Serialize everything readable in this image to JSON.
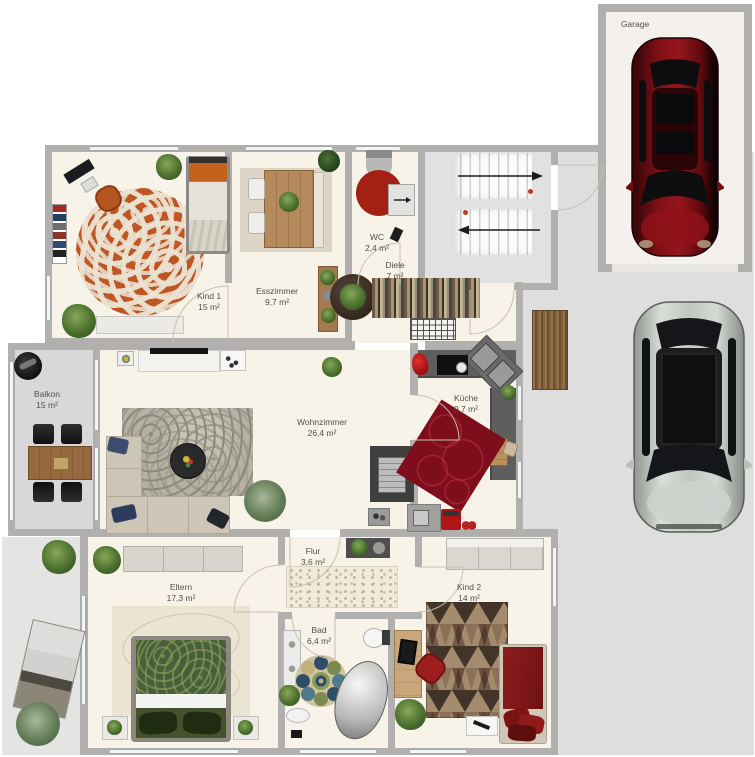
{
  "rooms": {
    "garage": {
      "name": "Garage"
    },
    "kind1": {
      "name": "Kind 1",
      "area": "15 m²"
    },
    "esszimmer": {
      "name": "Esszimmer",
      "area": "9,7 m²"
    },
    "wc": {
      "name": "WC",
      "area": "2,4 m²"
    },
    "diele": {
      "name": "Diele",
      "area": "7 m²"
    },
    "balkon": {
      "name": "Balkon",
      "area": "15 m²"
    },
    "wohnzimmer": {
      "name": "Wohnzimmer",
      "area": "26,4 m²"
    },
    "kueche": {
      "name": "Küche",
      "area": "9,7 m²"
    },
    "flur": {
      "name": "Flur",
      "area": "3,6 m²"
    },
    "eltern": {
      "name": "Eltern",
      "area": "17,3 m²"
    },
    "bad": {
      "name": "Bad",
      "area": "6,4 m²"
    },
    "kind2": {
      "name": "Kind 2",
      "area": "14 m²"
    }
  },
  "palette": {
    "wall": "#b2b0ae",
    "floor": "#f8f3e8",
    "driveway": "#dedede",
    "terrace": "#e4e4e2",
    "balcony_floor": "#d8d8da",
    "garage_floor": "#f4f1ec",
    "car_red": "#7a1016",
    "car_silver": "#c3c8c4",
    "rug_orange": "#bf5724",
    "rug_red": "#7e0e1c",
    "bed_green": "#46603c",
    "bed_red": "#8c1c1c",
    "kitchen_counter": "#5e5e5e"
  }
}
